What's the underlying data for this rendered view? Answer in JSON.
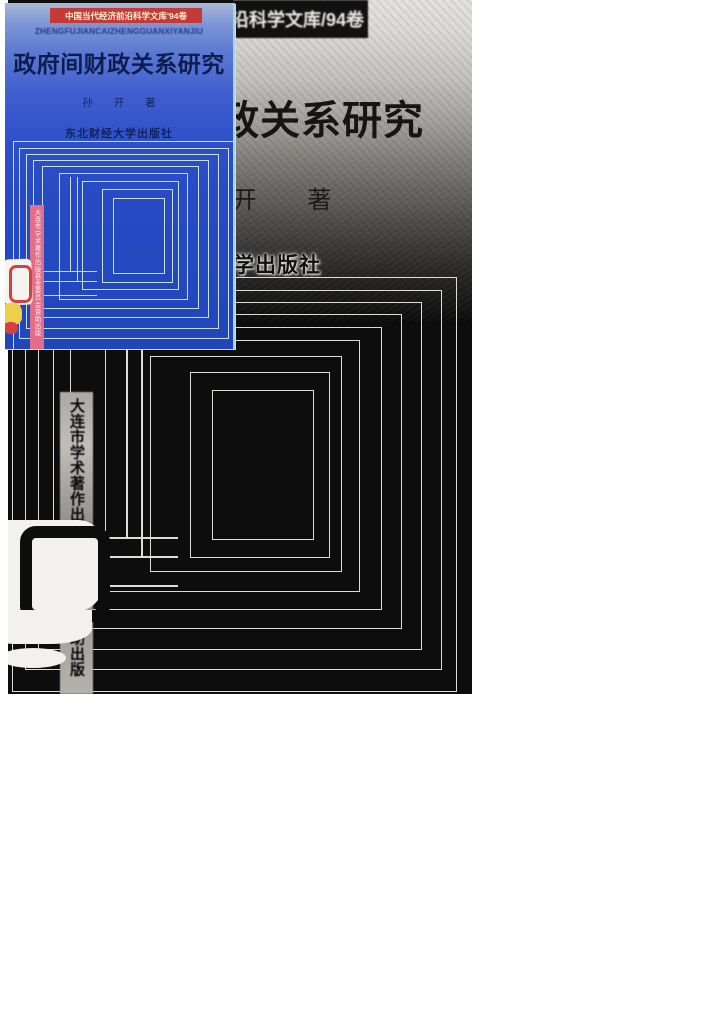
{
  "cover_inset": {
    "series_banner": "中国当代经济前沿科学文库'94卷",
    "pinyin": "ZHENGFUJIANCAIZHENGGUANXIYANJIU",
    "title": "政府间财政关系研究",
    "author": "孙 开 著",
    "publisher": "东北财经大学出版社",
    "fund_strip": "大连市学术著作出版基金委员会资助出版",
    "colors": {
      "background_blue": "#2c4ec9",
      "banner_red": "#c43a36",
      "strip_pink": "#e26e8c",
      "pattern_line": "#c9e0d6",
      "title_navy": "#0e1c50",
      "logo_yellow": "#eecf4a",
      "logo_red": "#d84040"
    }
  },
  "scan": {
    "series_banner": "中国当代经济前沿科学文库/94卷",
    "title": "政府间财政关系研究",
    "author": "孙 开 著",
    "publisher": "东北财经大学出版社",
    "fund_strip": "大连市学术著作出版基金委员会资助出版",
    "colors": {
      "background_black": "#0d0d0d",
      "pattern_line": "#dedcd6",
      "gradient_top_grey": "#e4e2df"
    }
  }
}
